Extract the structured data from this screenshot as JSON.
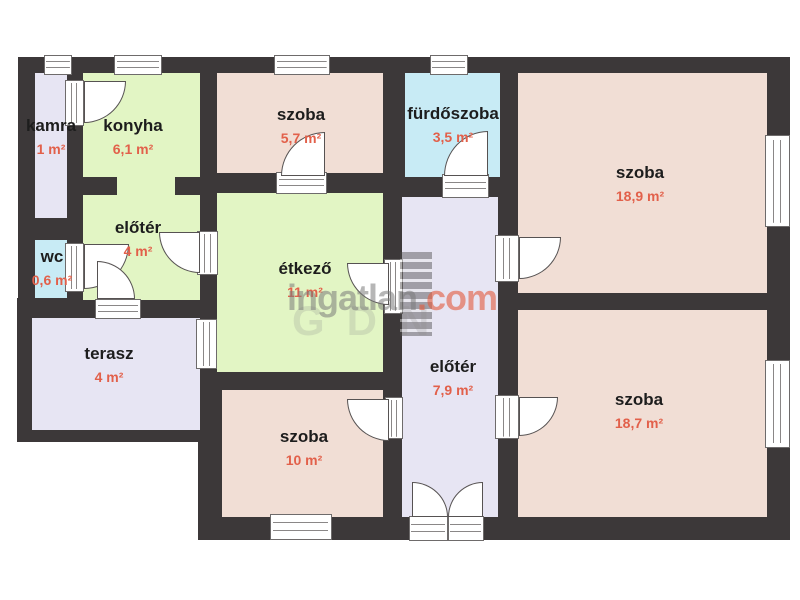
{
  "palette": {
    "wall": "#3c3839",
    "wline": "#8a8787",
    "pink": "#f1ded5",
    "green": "#e2f5c4",
    "lavender": "#e7e5f3",
    "blue": "#c8ebf5",
    "name_ink": "#1d1d1d",
    "area_ink": "#e2604a",
    "watermark_gray": "#7a7a7a",
    "watermark_orange": "#e25d40"
  },
  "rooms": [
    {
      "id": "kamra",
      "name": "kamra",
      "area": "1 m²",
      "color": "#e7e5f3"
    },
    {
      "id": "konyha",
      "name": "konyha",
      "area": "6,1 m²",
      "color": "#e2f5c4"
    },
    {
      "id": "szoba-5-7",
      "name": "szoba",
      "area": "5,7 m²",
      "color": "#f1ded5"
    },
    {
      "id": "furdoszoba",
      "name": "fürdőszoba",
      "area": "3,5 m²",
      "color": "#c8ebf5"
    },
    {
      "id": "szoba-18-9",
      "name": "szoba",
      "area": "18,9 m²",
      "color": "#f1ded5"
    },
    {
      "id": "wc",
      "name": "wc",
      "area": "0,6 m²",
      "color": "#c8ebf5"
    },
    {
      "id": "eloter-4",
      "name": "előtér",
      "area": "4 m²",
      "color": "#e2f5c4"
    },
    {
      "id": "etkezo",
      "name": "étkező",
      "area": "11 m²",
      "color": "#e2f5c4"
    },
    {
      "id": "terasz",
      "name": "terasz",
      "area": "4 m²",
      "color": "#e7e5f3"
    },
    {
      "id": "szoba-10",
      "name": "szoba",
      "area": "10 m²",
      "color": "#f1ded5"
    },
    {
      "id": "eloter-7-9",
      "name": "előtér",
      "area": "7,9 m²",
      "color": "#e7e5f3"
    },
    {
      "id": "szoba-18-7",
      "name": "szoba",
      "area": "18,7 m²",
      "color": "#f1ded5"
    }
  ],
  "watermark": {
    "brand": "ingatlan",
    "tld": ".com",
    "ghost": "GDN"
  }
}
